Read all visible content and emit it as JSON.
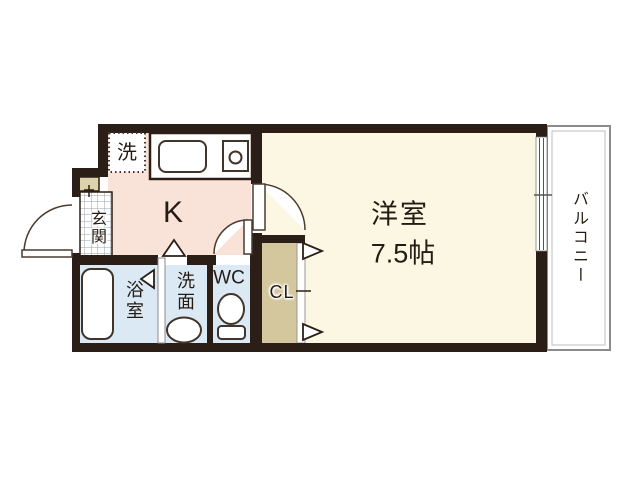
{
  "floorplan": {
    "type": "apartment-1K-floor-plan",
    "rooms": {
      "kitchen": {
        "label": "K"
      },
      "western_room": {
        "label": "洋室",
        "size": "7.5帖"
      },
      "balcony": {
        "label": "バルコニー"
      },
      "entrance": {
        "label": "玄関"
      },
      "bath": {
        "label": "浴室"
      },
      "washroom": {
        "label": "洗面"
      },
      "toilet": {
        "label": "WC"
      },
      "closet": {
        "label": "CL"
      },
      "laundry": {
        "label": "洗"
      }
    },
    "colors": {
      "wall": "#2b1e16",
      "kitchen_floor": "#f9e2d7",
      "western_room_floor": "#fbf7e2",
      "wet_area_floor": "#dbe9f4",
      "closet_floor": "#d4c79d",
      "entrance_step": "#ddd3aa",
      "tile_grid_line": "#9aa0a8",
      "balcony_border": "#8b8b8b",
      "background": "#ffffff"
    }
  }
}
